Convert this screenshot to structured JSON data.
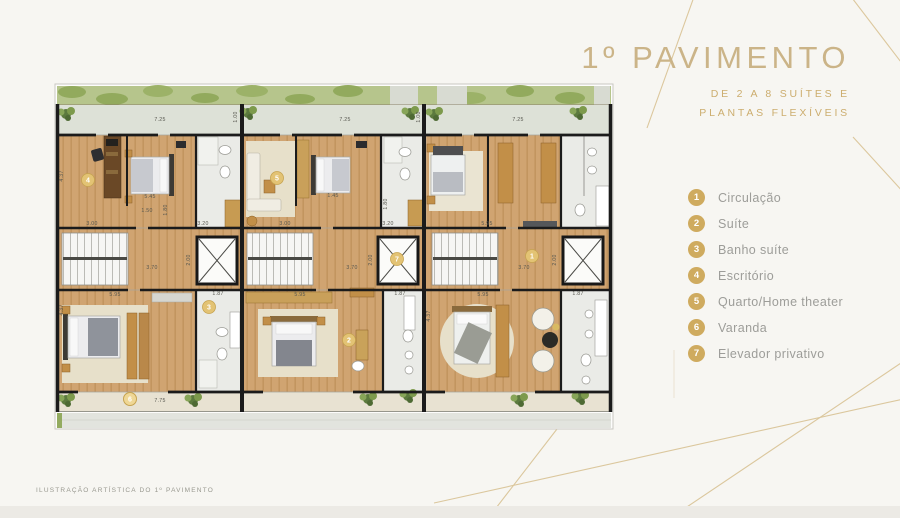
{
  "header": {
    "title": "1º PAVIMENTO",
    "subtitle_line1": "DE 2 A 8 SUÍTES E",
    "subtitle_line2": "PLANTAS FLEXÍVEIS"
  },
  "legend": {
    "items": [
      {
        "num": "1",
        "label": "Circulação"
      },
      {
        "num": "2",
        "label": "Suíte"
      },
      {
        "num": "3",
        "label": "Banho suíte"
      },
      {
        "num": "4",
        "label": "Escritório"
      },
      {
        "num": "5",
        "label": "Quarto/Home theater"
      },
      {
        "num": "6",
        "label": "Varanda"
      },
      {
        "num": "7",
        "label": "Elevador privativo"
      }
    ]
  },
  "footer": {
    "caption": "ILUSTRAÇÃO ARTÍSTICA DO 1º PAVIMENTO"
  },
  "plan": {
    "badges": [
      {
        "n": "4"
      },
      {
        "n": "5"
      },
      {
        "n": "3"
      },
      {
        "n": "6"
      },
      {
        "n": "7"
      },
      {
        "n": "1"
      },
      {
        "n": "2"
      }
    ],
    "dims": [
      "7.25",
      "7.25",
      "7.25",
      "1.00",
      "1.00",
      "4.37",
      "4.37",
      "4.37",
      "3.00",
      "3.20",
      "3.00",
      "3.20",
      "5.95",
      "5.45",
      "1.50",
      "1.80",
      "1.45",
      "1.80",
      "3.70",
      "3.70",
      "3.70",
      "2.00",
      "2.00",
      "2.00",
      "5.95",
      "5.95",
      "5.95",
      "1.87",
      "1.87",
      "1.87",
      "7.75"
    ]
  },
  "colors": {
    "accent_gold": "#cbb488",
    "subtitle_gold": "#ccad6e",
    "legend_badge": "#cfab5f",
    "plan_badge": "#e3c374",
    "wood_floor": "#d0a471",
    "furniture_wood": "#c28f48",
    "garden_green": "#b6c58c",
    "bathroom_tile": "#eaebe7",
    "balcony": "#e8e2d2",
    "wall": "#1b1b1b",
    "decor_line": "#d8c294"
  }
}
